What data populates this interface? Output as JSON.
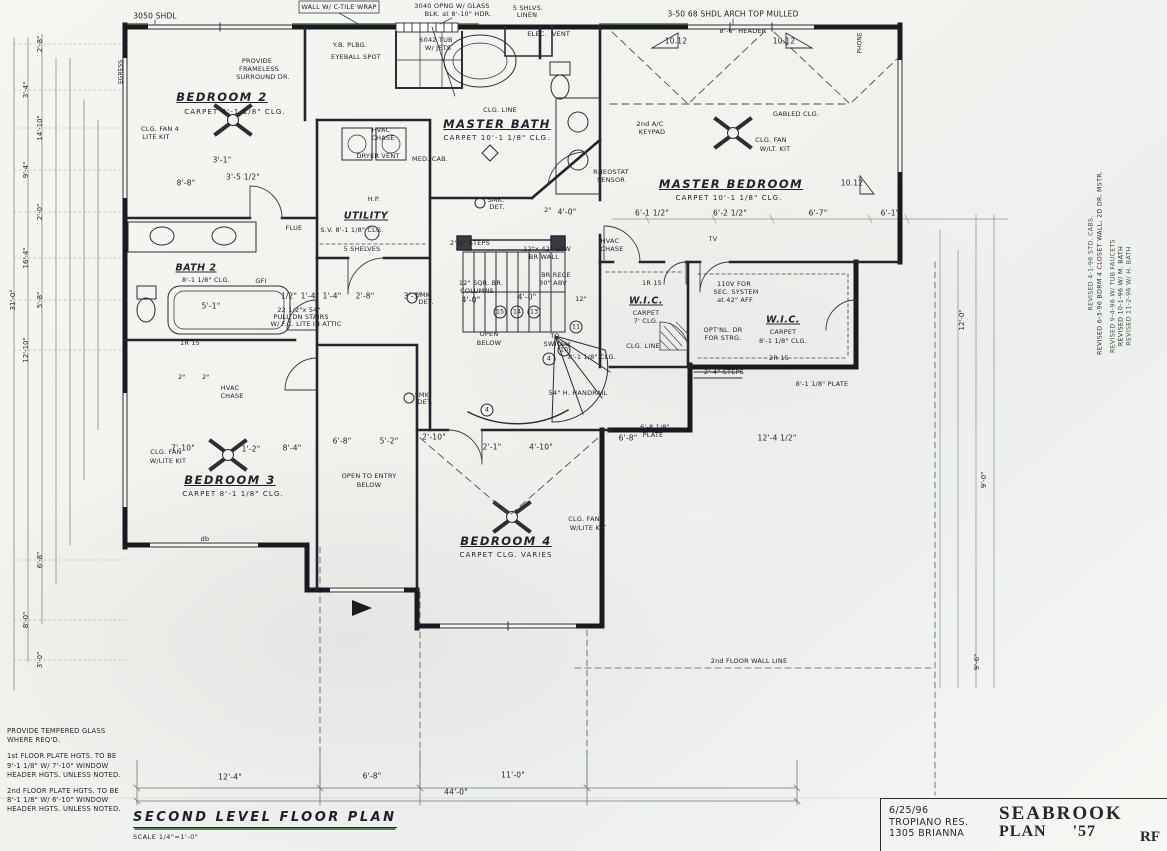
{
  "title_block": {
    "date": "6/25/96",
    "client": "TROPIANO RES.",
    "address": "1305 BRIANNA",
    "plan_name": "SEABROOK",
    "plan_word": "PLAN",
    "plan_number": "'57",
    "initials": "RF"
  },
  "drawing_title": {
    "name": "SECOND LEVEL FLOOR PLAN",
    "scale": "SCALE 1/4\"=1'-0\""
  },
  "notes": [
    "PROVIDE TEMPERED GLASS WHERE REQ'D.",
    "1st FLOOR PLATE HGTS. TO BE 9'-1 1/8\" W/ 7'-10\" WINDOW HEADER HGTS. UNLESS NOTED.",
    "2nd FLOOR PLATE HGTS. TO BE 8'-1 1/8\" W/ 6'-10\" WINDOW HEADER HGTS. UNLESS NOTED."
  ],
  "revisions": [
    "REVISED 4-1-96 STD. CABS.",
    "REVISED 6-3-96 BDRM 4 CLOSET WALL, 2D DR. MSTR.",
    "REVISED 9-4-96 W/ TUB FAUCETS",
    "REVISED 10-1-96 W/ M. BATH",
    "REVISED 11-2-96 W/ H. BATH"
  ],
  "rooms": [
    {
      "name": "BEDROOM 2",
      "finish": "CARPET",
      "ceiling": "8'-1 1/8\" CLG."
    },
    {
      "name": "MASTER BATH",
      "finish": "CARPET",
      "ceiling": "10'-1 1/8\" CLG."
    },
    {
      "name": "MASTER BEDROOM",
      "finish": "CARPET",
      "ceiling": "10'-1 1/8\" CLG."
    },
    {
      "name": "BATH 2",
      "ceiling": "8'-1 1/8\" CLG."
    },
    {
      "name": "UTILITY",
      "ceiling": "8'-1 1/8\" CLG."
    },
    {
      "name": "W.I.C.",
      "finish": "CARPET",
      "ceiling": "7' CLG."
    },
    {
      "name": "W.I.C.",
      "finish": "CARPET",
      "ceiling": "8'-1 1/8\" CLG."
    },
    {
      "name": "BEDROOM 3",
      "finish": "CARPET",
      "ceiling": "8'-1 1/8\" CLG."
    },
    {
      "name": "BEDROOM 4",
      "finish": "CARPET",
      "ceiling": "CLG. VARIES"
    }
  ],
  "plan": {
    "labels": [
      [
        "BEDROOM 2",
        222,
        97,
        "room"
      ],
      [
        "CARPET   8'-1 1/8\" CLG.",
        235,
        112,
        "sub"
      ],
      [
        "CLG. FAN 4",
        160,
        129,
        "tiny"
      ],
      [
        "LITE KIT",
        156,
        137,
        "tiny"
      ],
      [
        "CLG. LINE",
        500,
        110,
        "tiny"
      ],
      [
        "MASTER BATH",
        497,
        124,
        "room"
      ],
      [
        "CARPET   10'-1 1/8\" CLG.",
        497,
        138,
        "sub"
      ],
      [
        "MASTER BEDROOM",
        731,
        184,
        "room"
      ],
      [
        "CARPET   10'-1 1/8\" CLG.",
        729,
        198,
        "sub"
      ],
      [
        "BATH 2",
        196,
        268,
        "room-sm"
      ],
      [
        "8'-1 1/8\" CLG.",
        206,
        280,
        "tiny"
      ],
      [
        "UTILITY",
        366,
        216,
        "room-sm"
      ],
      [
        "S.V. 8'-1 1/8\" CLG.",
        352,
        230,
        "tiny"
      ],
      [
        "5 SHELVES",
        362,
        249,
        "tiny"
      ],
      [
        "W.I.C.",
        646,
        301,
        "room-sm"
      ],
      [
        "CARPET",
        646,
        313,
        "tiny"
      ],
      [
        "7' CLG.",
        646,
        321,
        "tiny"
      ],
      [
        "CLG. LINE",
        643,
        346,
        "tiny"
      ],
      [
        "W.I.C.",
        783,
        320,
        "room-sm"
      ],
      [
        "CARPET",
        783,
        332,
        "tiny"
      ],
      [
        "8'-1 1/8\" CLG.",
        783,
        341,
        "tiny"
      ],
      [
        "BEDROOM 3",
        230,
        480,
        "room"
      ],
      [
        "CARPET   8'-1 1/8\" CLG.",
        233,
        494,
        "sub"
      ],
      [
        "CLG. FAN",
        166,
        452,
        "tiny"
      ],
      [
        "W/LITE KIT",
        168,
        461,
        "tiny"
      ],
      [
        "BEDROOM 4",
        506,
        541,
        "room"
      ],
      [
        "CARPET   CLG. VARIES",
        506,
        555,
        "sub"
      ],
      [
        "CLG. FAN",
        584,
        519,
        "tiny"
      ],
      [
        "W/LITE KIT",
        588,
        528,
        "tiny"
      ],
      [
        "OPEN TO ENTRY",
        369,
        476,
        "tiny"
      ],
      [
        "BELOW",
        369,
        485,
        "tiny"
      ],
      [
        "OPEN",
        489,
        334,
        "tiny"
      ],
      [
        "BELOW",
        489,
        343,
        "tiny"
      ],
      [
        "CLG. FAN",
        771,
        140,
        "tiny"
      ],
      [
        "W/LT. KIT",
        775,
        149,
        "tiny"
      ],
      [
        "GABLED CLG.",
        796,
        114,
        "tiny"
      ],
      [
        "2nd A/C",
        650,
        124,
        "tiny"
      ],
      [
        "KEYPAD",
        652,
        132,
        "tiny"
      ],
      [
        "RHEOSTAT",
        611,
        172,
        "tiny"
      ],
      [
        "SENSOR",
        611,
        180,
        "tiny"
      ],
      [
        "TV",
        713,
        239,
        "tiny"
      ],
      [
        "HVAC",
        381,
        130,
        "tiny"
      ],
      [
        "CHASE",
        383,
        138,
        "tiny"
      ],
      [
        "HVAC",
        610,
        241,
        "tiny"
      ],
      [
        "CHASE",
        612,
        249,
        "tiny"
      ],
      [
        "HVAC",
        230,
        388,
        "tiny"
      ],
      [
        "CHASE",
        232,
        396,
        "tiny"
      ],
      [
        "FLUE",
        294,
        228,
        "tiny"
      ],
      [
        "SMK.",
        496,
        200,
        "tiny"
      ],
      [
        "DET.",
        497,
        207,
        "tiny"
      ],
      [
        "SMK.",
        424,
        295,
        "tiny"
      ],
      [
        "DET.",
        426,
        302,
        "tiny"
      ],
      [
        "SMK.",
        423,
        395,
        "tiny"
      ],
      [
        "DET.",
        425,
        402,
        "tiny"
      ],
      [
        "5'-1\"",
        211,
        306,
        "dim"
      ],
      [
        "GFI",
        261,
        281,
        "tiny"
      ],
      [
        "1R 15",
        190,
        343,
        "tiny"
      ],
      [
        "MED. CAB.",
        430,
        159,
        "tiny"
      ],
      [
        "DRYER VENT",
        378,
        156,
        "tiny"
      ],
      [
        "H.P.",
        374,
        199,
        "tiny"
      ],
      [
        "Y.B. PLBG.",
        350,
        45,
        "tiny"
      ],
      [
        "EYEBALL SPOT",
        356,
        57,
        "tiny"
      ],
      [
        "PROVIDE",
        257,
        61,
        "tiny"
      ],
      [
        "FRAMELESS",
        259,
        69,
        "tiny"
      ],
      [
        "SURROUND DR.",
        263,
        77,
        "tiny"
      ],
      [
        "6042 TUB",
        436,
        40,
        "tiny"
      ],
      [
        "W/ JETS",
        438,
        48,
        "tiny"
      ],
      [
        "ELEC.",
        537,
        34,
        "tiny"
      ],
      [
        "VENT",
        561,
        34,
        "tiny"
      ],
      [
        "3050 SHDL",
        155,
        16,
        "dim"
      ],
      [
        "WALL W/ C-TILE WRAP",
        339,
        7,
        "tiny"
      ],
      [
        "3040 OPNG W/ GLASS",
        452,
        6,
        "tiny"
      ],
      [
        "BLK. at 8'-10\" HDR.",
        458,
        14,
        "tiny"
      ],
      [
        "5 SHLVS.",
        528,
        8,
        "tiny"
      ],
      [
        "LINEN",
        527,
        15,
        "tiny"
      ],
      [
        "3-50 68 SHDL ARCH TOP MULLED",
        733,
        14,
        "dim"
      ],
      [
        "8'-6\" HEADER",
        743,
        31,
        "tiny"
      ],
      [
        "10.12",
        676,
        41,
        "dim"
      ],
      [
        "10.12",
        784,
        41,
        "dim"
      ],
      [
        "10.12",
        852,
        183,
        "dim"
      ],
      [
        "PHONE",
        860,
        43,
        "vtiny"
      ],
      [
        "EGRESS",
        121,
        72,
        "vtiny"
      ],
      [
        "2'-4\" STEPS",
        470,
        243,
        "tiny"
      ],
      [
        "12\"x 42\" LOW",
        547,
        249,
        "tiny"
      ],
      [
        "BR WALL",
        544,
        257,
        "tiny"
      ],
      [
        "BR RECE",
        556,
        275,
        "tiny"
      ],
      [
        "30\" ABV",
        553,
        283,
        "tiny"
      ],
      [
        "12\" SQR. BR.",
        481,
        283,
        "tiny"
      ],
      [
        "COLUMNS",
        477,
        291,
        "tiny"
      ],
      [
        "4'-0\"",
        471,
        300,
        "dim"
      ],
      [
        "4'-0\"",
        527,
        297,
        "dim"
      ],
      [
        "12\"",
        581,
        299,
        "tiny"
      ],
      [
        "2°",
        548,
        210,
        "tiny"
      ],
      [
        "4'-0\"",
        567,
        212,
        "dim"
      ],
      [
        "TO",
        555,
        336,
        "tiny"
      ],
      [
        "SWITCH",
        557,
        344,
        "tiny"
      ],
      [
        "54\" H. HANDRAIL",
        578,
        393,
        "tiny"
      ],
      [
        "15",
        500,
        312,
        "circ"
      ],
      [
        "14",
        517,
        312,
        "circ"
      ],
      [
        "13",
        534,
        312,
        "circ"
      ],
      [
        "11",
        576,
        327,
        "circ"
      ],
      [
        "10",
        564,
        350,
        "circ"
      ],
      [
        "4",
        549,
        359,
        "circ"
      ],
      [
        "4",
        487,
        410,
        "circ"
      ],
      [
        "8'-1 1/8\" CLG.",
        592,
        357,
        "tiny"
      ],
      [
        "6'-8 1/8\"",
        655,
        427,
        "tiny"
      ],
      [
        "PLATE",
        653,
        435,
        "tiny"
      ],
      [
        "2'-4\" STEPS",
        724,
        372,
        "tiny"
      ],
      [
        "2R 15",
        779,
        358,
        "tiny"
      ],
      [
        "8'-1 1/8\" PLATE",
        822,
        384,
        "tiny"
      ],
      [
        "110V FOR",
        734,
        284,
        "tiny"
      ],
      [
        "SEC. SYSTEM",
        736,
        292,
        "tiny"
      ],
      [
        "at 42\" AFF",
        735,
        300,
        "tiny"
      ],
      [
        "OPT'NL. DR",
        723,
        330,
        "tiny"
      ],
      [
        "FOR STRG.",
        723,
        338,
        "tiny"
      ],
      [
        "1R 15",
        652,
        283,
        "tiny"
      ],
      [
        "OPT'NL. DR FOR STRG.",
        0,
        -50,
        "tiny"
      ],
      [
        "8'-8\"",
        186,
        183,
        "dim"
      ],
      [
        "3'-5 1/2\"",
        243,
        177,
        "dim"
      ],
      [
        "3'-1\"",
        222,
        160,
        "dim"
      ],
      [
        "1/2\"",
        289,
        296,
        "dim"
      ],
      [
        "1'-4\"",
        310,
        296,
        "dim"
      ],
      [
        "1'-4\"",
        332,
        296,
        "dim"
      ],
      [
        "2'-8\"",
        365,
        296,
        "dim"
      ],
      [
        "3'-1\"",
        413,
        296,
        "dim"
      ],
      [
        "22 1/2\"x 54\"",
        299,
        310,
        "tiny"
      ],
      [
        "PULL DN STAIRS",
        301,
        317,
        "tiny"
      ],
      [
        "W/ F.C. LITE IN ATTIC",
        306,
        324,
        "tiny"
      ],
      [
        "6'-1 1/2\"",
        652,
        213,
        "dim"
      ],
      [
        "6'-2 1/2\"",
        730,
        213,
        "dim"
      ],
      [
        "6'-7\"",
        818,
        213,
        "dim"
      ],
      [
        "6'-1\"",
        890,
        213,
        "dim"
      ],
      [
        "7'-10\"",
        183,
        448,
        "dim"
      ],
      [
        "1'-2\"",
        251,
        449,
        "dim"
      ],
      [
        "8'-4\"",
        292,
        448,
        "dim"
      ],
      [
        "6'-8\"",
        342,
        441,
        "dim"
      ],
      [
        "5'-2\"",
        389,
        441,
        "dim"
      ],
      [
        "2'-10\"",
        434,
        437,
        "dim"
      ],
      [
        "2'-1\"",
        492,
        447,
        "dim"
      ],
      [
        "4'-10\"",
        541,
        447,
        "dim"
      ],
      [
        "6'-8\"",
        628,
        438,
        "dim"
      ],
      [
        "12'-4 1/2\"",
        777,
        438,
        "dim"
      ],
      [
        "2°",
        182,
        377,
        "tiny"
      ],
      [
        "2°",
        206,
        377,
        "tiny"
      ],
      [
        "db",
        205,
        539,
        "tiny"
      ],
      [
        "12'-4\"",
        230,
        777,
        "dim"
      ],
      [
        "6'-8\"",
        372,
        776,
        "dim"
      ],
      [
        "11'-0\"",
        513,
        775,
        "dim"
      ],
      [
        "44'-0\"",
        456,
        792,
        "dim"
      ],
      [
        "2nd FLOOR WALL LINE",
        749,
        661,
        "tiny"
      ],
      [
        "2'-8\"",
        40,
        44,
        "vdim"
      ],
      [
        "3'-4\"",
        26,
        90,
        "vdim"
      ],
      [
        "14'-10\"",
        40,
        128,
        "vdim"
      ],
      [
        "9'-4\"",
        26,
        170,
        "vdim"
      ],
      [
        "2'-0\"",
        40,
        212,
        "vdim"
      ],
      [
        "16'-4\"",
        26,
        258,
        "vdim"
      ],
      [
        "5'-8\"",
        40,
        300,
        "vdim"
      ],
      [
        "12'-10\"",
        26,
        350,
        "vdim"
      ],
      [
        "31'-0\"",
        13,
        300,
        "vdim"
      ],
      [
        "6'-8\"",
        40,
        560,
        "vdim"
      ],
      [
        "8'-0\"",
        26,
        620,
        "vdim"
      ],
      [
        "3'-0\"",
        40,
        660,
        "vdim"
      ],
      [
        "12'-0\"",
        962,
        320,
        "vdim"
      ],
      [
        "9'-0\"",
        984,
        480,
        "vdim"
      ],
      [
        "9'-6\"",
        977,
        662,
        "vdim"
      ]
    ]
  }
}
